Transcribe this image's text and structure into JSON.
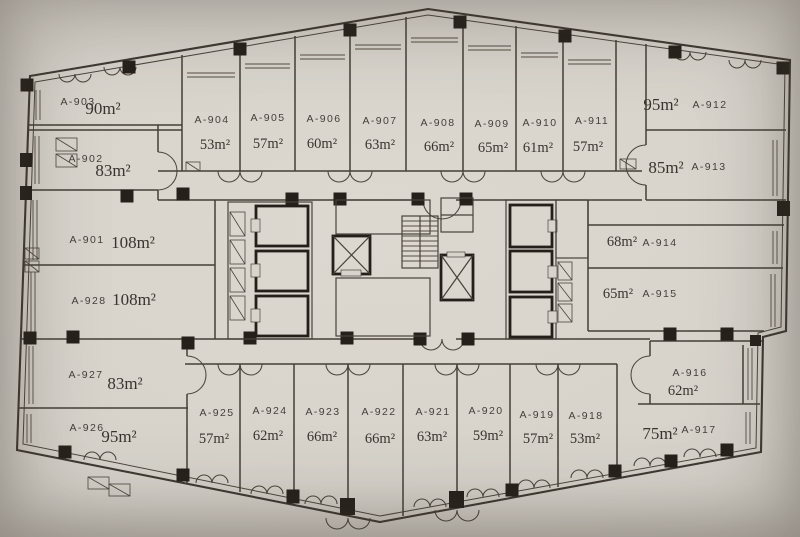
{
  "plan": {
    "type": "floor-plan",
    "units": [
      {
        "id": "A-901",
        "area": "108m²"
      },
      {
        "id": "A-902",
        "area": "83m²"
      },
      {
        "id": "A-903",
        "area": "90m²"
      },
      {
        "id": "A-904",
        "area": "53m²"
      },
      {
        "id": "A-905",
        "area": "57m²"
      },
      {
        "id": "A-906",
        "area": "60m²"
      },
      {
        "id": "A-907",
        "area": "63m²"
      },
      {
        "id": "A-908",
        "area": "66m²"
      },
      {
        "id": "A-909",
        "area": "65m²"
      },
      {
        "id": "A-910",
        "area": "61m²"
      },
      {
        "id": "A-911",
        "area": "57m²"
      },
      {
        "id": "A-912",
        "area": "95m²"
      },
      {
        "id": "A-913",
        "area": "85m²"
      },
      {
        "id": "A-914",
        "area": "68m²"
      },
      {
        "id": "A-915",
        "area": "65m²"
      },
      {
        "id": "A-916",
        "area": "62m²"
      },
      {
        "id": "A-917",
        "area": "75m²"
      },
      {
        "id": "A-918",
        "area": "53m²"
      },
      {
        "id": "A-919",
        "area": "57m²"
      },
      {
        "id": "A-920",
        "area": "59m²"
      },
      {
        "id": "A-921",
        "area": "63m²"
      },
      {
        "id": "A-922",
        "area": "66m²"
      },
      {
        "id": "A-923",
        "area": "66m²"
      },
      {
        "id": "A-924",
        "area": "62m²"
      },
      {
        "id": "A-925",
        "area": "57m²"
      },
      {
        "id": "A-926",
        "area": "95m²"
      },
      {
        "id": "A-927",
        "area": "83m²"
      },
      {
        "id": "A-928",
        "area": "108m²"
      }
    ],
    "colors": {
      "paper": "#d8d4cc",
      "ink": "#45403a",
      "column": "#25211a"
    }
  }
}
